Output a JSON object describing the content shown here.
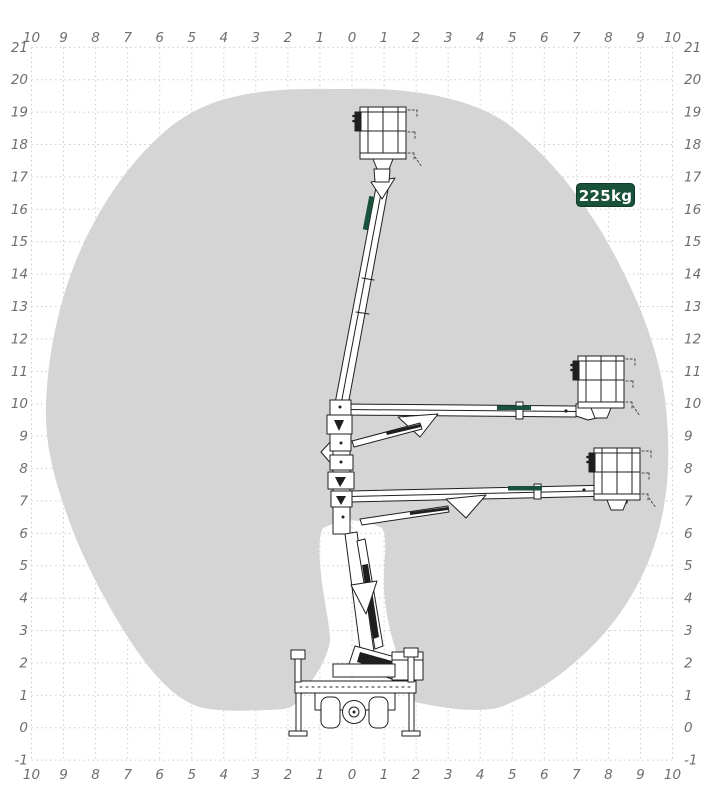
{
  "page": {
    "background": "#ffffff"
  },
  "badge": {
    "label": "225kg",
    "bg": "#1a513a",
    "border": "#0f3a28",
    "text_color": "#ffffff"
  },
  "envelope": {
    "fill": "#d5d5d5"
  },
  "grid": {
    "dot_color": "#cbcbcb",
    "label_color": "#6e6e6e",
    "meters_per_cell": 1
  },
  "axes": {
    "x_labels": [
      "10",
      "9",
      "8",
      "7",
      "6",
      "5",
      "4",
      "3",
      "2",
      "1",
      "0",
      "1",
      "2",
      "3",
      "4",
      "5",
      "6",
      "7",
      "8",
      "9",
      "10"
    ],
    "y_labels": [
      "21",
      "20",
      "19",
      "18",
      "17",
      "16",
      "15",
      "14",
      "13",
      "12",
      "11",
      "10",
      "9",
      "8",
      "7",
      "6",
      "5",
      "4",
      "3",
      "2",
      "1",
      "0",
      "-1"
    ]
  },
  "machine": {
    "type_hint": "spider aerial work platform, side view, three basket positions",
    "brand_mark_color": "#1a513a",
    "line_color": "#1f1f1f"
  },
  "chart_data": {
    "type": "area",
    "title": "",
    "xlabel": "",
    "ylabel": "",
    "x_range": [
      -10,
      10
    ],
    "y_range": [
      -1,
      21
    ],
    "grid": true,
    "capacity_label": "225kg",
    "max_working_height_m": 19.7,
    "max_outreach_m": 9.9,
    "envelope_outline_m": [
      [
        0,
        19.7
      ],
      [
        4.9,
        18.6
      ],
      [
        8.1,
        14.7
      ],
      [
        9.7,
        10.1
      ],
      [
        9.9,
        8.2
      ],
      [
        9.5,
        6.0
      ],
      [
        7.7,
        2.8
      ],
      [
        4.4,
        0.6
      ],
      [
        1.9,
        0.8
      ],
      [
        1.0,
        6.1
      ],
      [
        0,
        6.5
      ],
      [
        -0.8,
        6.1
      ],
      [
        -1.7,
        0.8
      ],
      [
        -4.6,
        0.6
      ],
      [
        -7.0,
        2.8
      ],
      [
        -8.9,
        6.5
      ],
      [
        -9.6,
        9.5
      ],
      [
        -9.2,
        12.9
      ],
      [
        -7.1,
        17.3
      ],
      [
        -2.6,
        19.6
      ]
    ],
    "basket_positions_m": [
      {
        "x": 1.0,
        "y": 19.0,
        "note": "boom fully raised"
      },
      {
        "x": 7.8,
        "y": 10.3,
        "note": "boom horizontal, upper"
      },
      {
        "x": 8.2,
        "y": 7.3,
        "note": "boom horizontal, lower"
      }
    ]
  }
}
